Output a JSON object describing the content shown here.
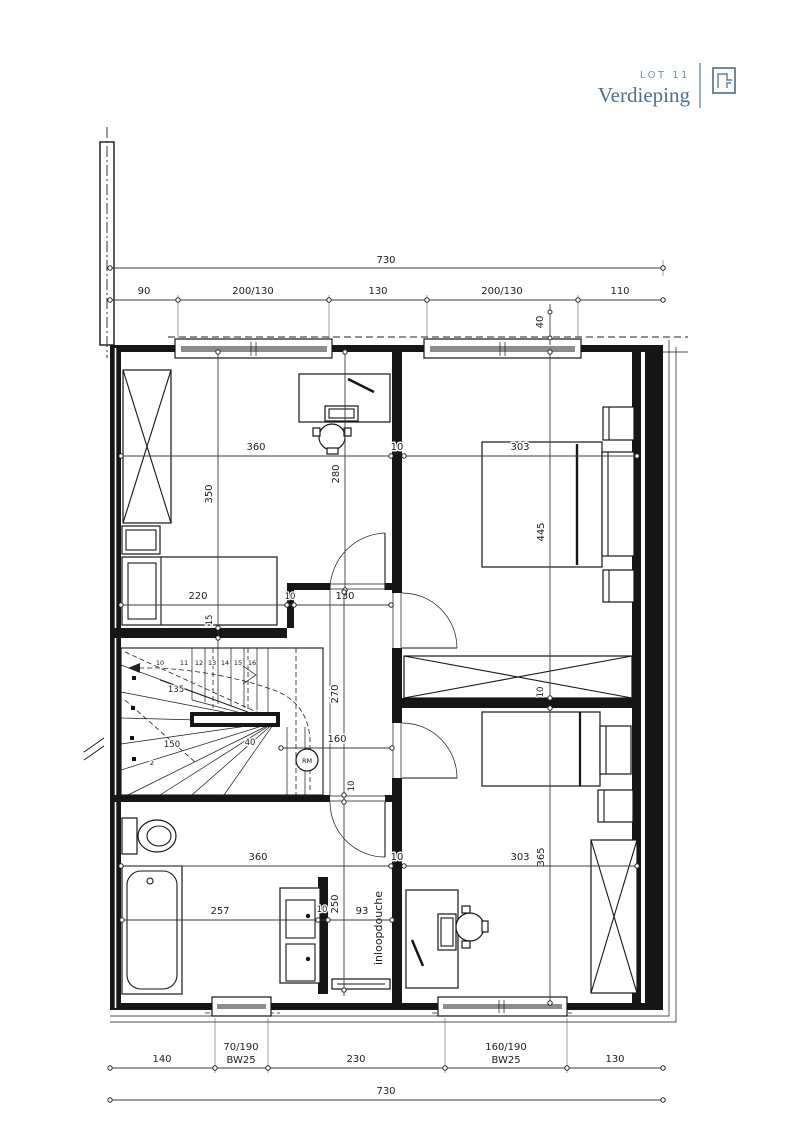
{
  "header": {
    "lot": "LOT 11",
    "title": "Verdieping"
  },
  "plan": {
    "dims": {
      "total": "730",
      "top_chain": [
        "90",
        "200/130",
        "130",
        "200/130",
        "110"
      ],
      "top_offset_40": "40",
      "left_width": "360",
      "right_width": "303",
      "wall": "10",
      "bed1_depth": "350",
      "bed1_inner": "280",
      "bed1_bed": "220",
      "wall15": "15",
      "pass130": "130",
      "bed2_depth": "445",
      "hall270": "270",
      "hall160": "160",
      "stair40": "40",
      "stair135": "135",
      "stair150": "150",
      "bed3_depth": "365",
      "tub257": "257",
      "shower93": "93",
      "bath250": "250",
      "bottom_chain": [
        "140",
        "70/190",
        "230",
        "160/190",
        "130"
      ],
      "bottom_sub": "BW25"
    },
    "stairs": {
      "numbers": [
        "2",
        "10",
        "11",
        "12",
        "13",
        "14",
        "15",
        "16"
      ]
    },
    "labels": {
      "shower": "inloopdouche",
      "smoke_detector": "RM"
    }
  }
}
